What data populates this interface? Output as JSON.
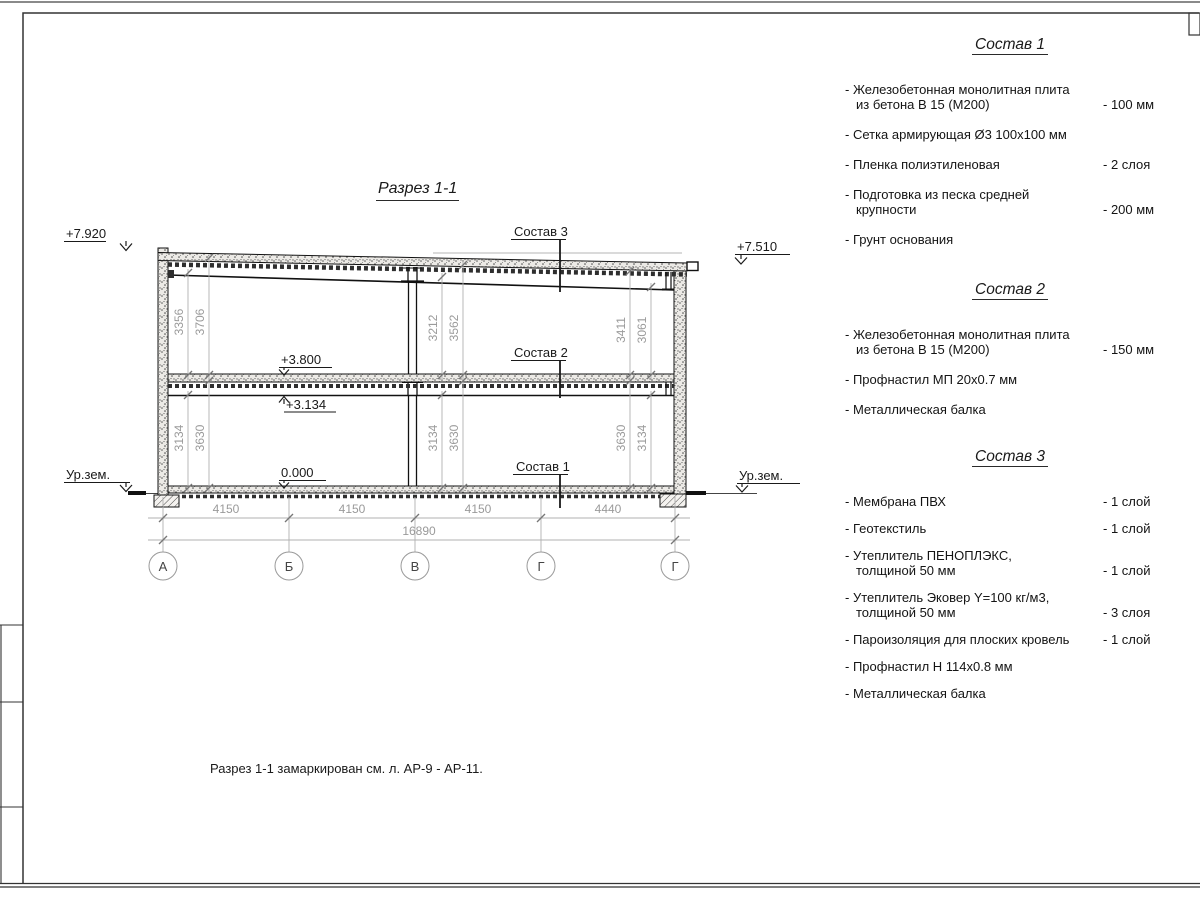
{
  "drawing": {
    "title": "Разрез 1-1",
    "elevations": {
      "top_left": "+7.920",
      "top_right": "+7.510",
      "floor": "+3.800",
      "beam": "+3.134",
      "zero": "0.000",
      "ground_left": "Ур.зем.",
      "ground_right": "Ур.зем."
    },
    "section_labels": {
      "s3": "Состав 3",
      "s2": "Состав 2",
      "s1": "Состав 1"
    },
    "vdims": {
      "ul1": "3356",
      "ul2": "3706",
      "um1": "3212",
      "um2": "3562",
      "ur1": "3411",
      "ur2": "3061",
      "ll1": "3134",
      "ll2": "3630",
      "lm1": "3134",
      "lm2": "3630",
      "lr1": "3630",
      "lr2": "3134"
    },
    "hdims": {
      "span1": "4150",
      "span2": "4150",
      "span3": "4150",
      "span4": "4440",
      "total": "16890"
    },
    "grid": {
      "a1": "А",
      "a2": "Б",
      "a3": "В",
      "a4": "Г",
      "a5": "Г"
    }
  },
  "panel": {
    "sections": [
      {
        "heading": "Состав 1",
        "items": [
          {
            "line1": "- Железобетонная  монолитная плита",
            "line2": "из бетона В 15 (М200)",
            "value": "- 100 мм"
          },
          {
            "line1": "- Сетка армирующая Ø3 100х100 мм",
            "line2": "",
            "value": ""
          },
          {
            "line1": "- Пленка полиэтиленовая",
            "line2": "",
            "value": "-  2 слоя"
          },
          {
            "line1": "- Подготовка из песка средней",
            "line2": "крупности",
            "value": "- 200 мм"
          },
          {
            "line1": "- Грунт основания",
            "line2": "",
            "value": ""
          }
        ]
      },
      {
        "heading": "Состав 2",
        "items": [
          {
            "line1": "- Железобетонная  монолитная плита",
            "line2": "из бетона В 15 (М200)",
            "value": "- 150 мм"
          },
          {
            "line1": "- Профнастил МП 20х0.7 мм",
            "line2": "",
            "value": ""
          },
          {
            "line1": "- Металлическая балка",
            "line2": "",
            "value": ""
          }
        ]
      },
      {
        "heading": "Состав 3",
        "items": [
          {
            "line1": "- Мембрана ПВХ",
            "line2": "",
            "value": "- 1 слой"
          },
          {
            "line1": "- Геотекстиль",
            "line2": "",
            "value": "- 1 слой"
          },
          {
            "line1": "- Утеплитель ПЕНОПЛЭКС,",
            "line2": "толщиной 50 мм",
            "value": "- 1 слой"
          },
          {
            "line1": "- Утеплитель Эковер Y=100 кг/м3,",
            "line2": "толщиной 50 мм",
            "value": "- 3 слоя"
          },
          {
            "line1": "- Пароизоляция для плоских кровель",
            "line2": "",
            "value": "- 1 слой"
          },
          {
            "line1": "- Профнастил Н 114х0.8 мм",
            "line2": "",
            "value": ""
          },
          {
            "line1": "- Металлическая балка",
            "line2": "",
            "value": ""
          }
        ]
      }
    ]
  },
  "note": "Разрез 1-1 замаркирован см. л. АР-9 - АР-11.",
  "colors": {
    "line": "#1a1a1a",
    "dim_gray": "#9a9a9a",
    "frame": "#333333",
    "bg": "#ffffff"
  }
}
